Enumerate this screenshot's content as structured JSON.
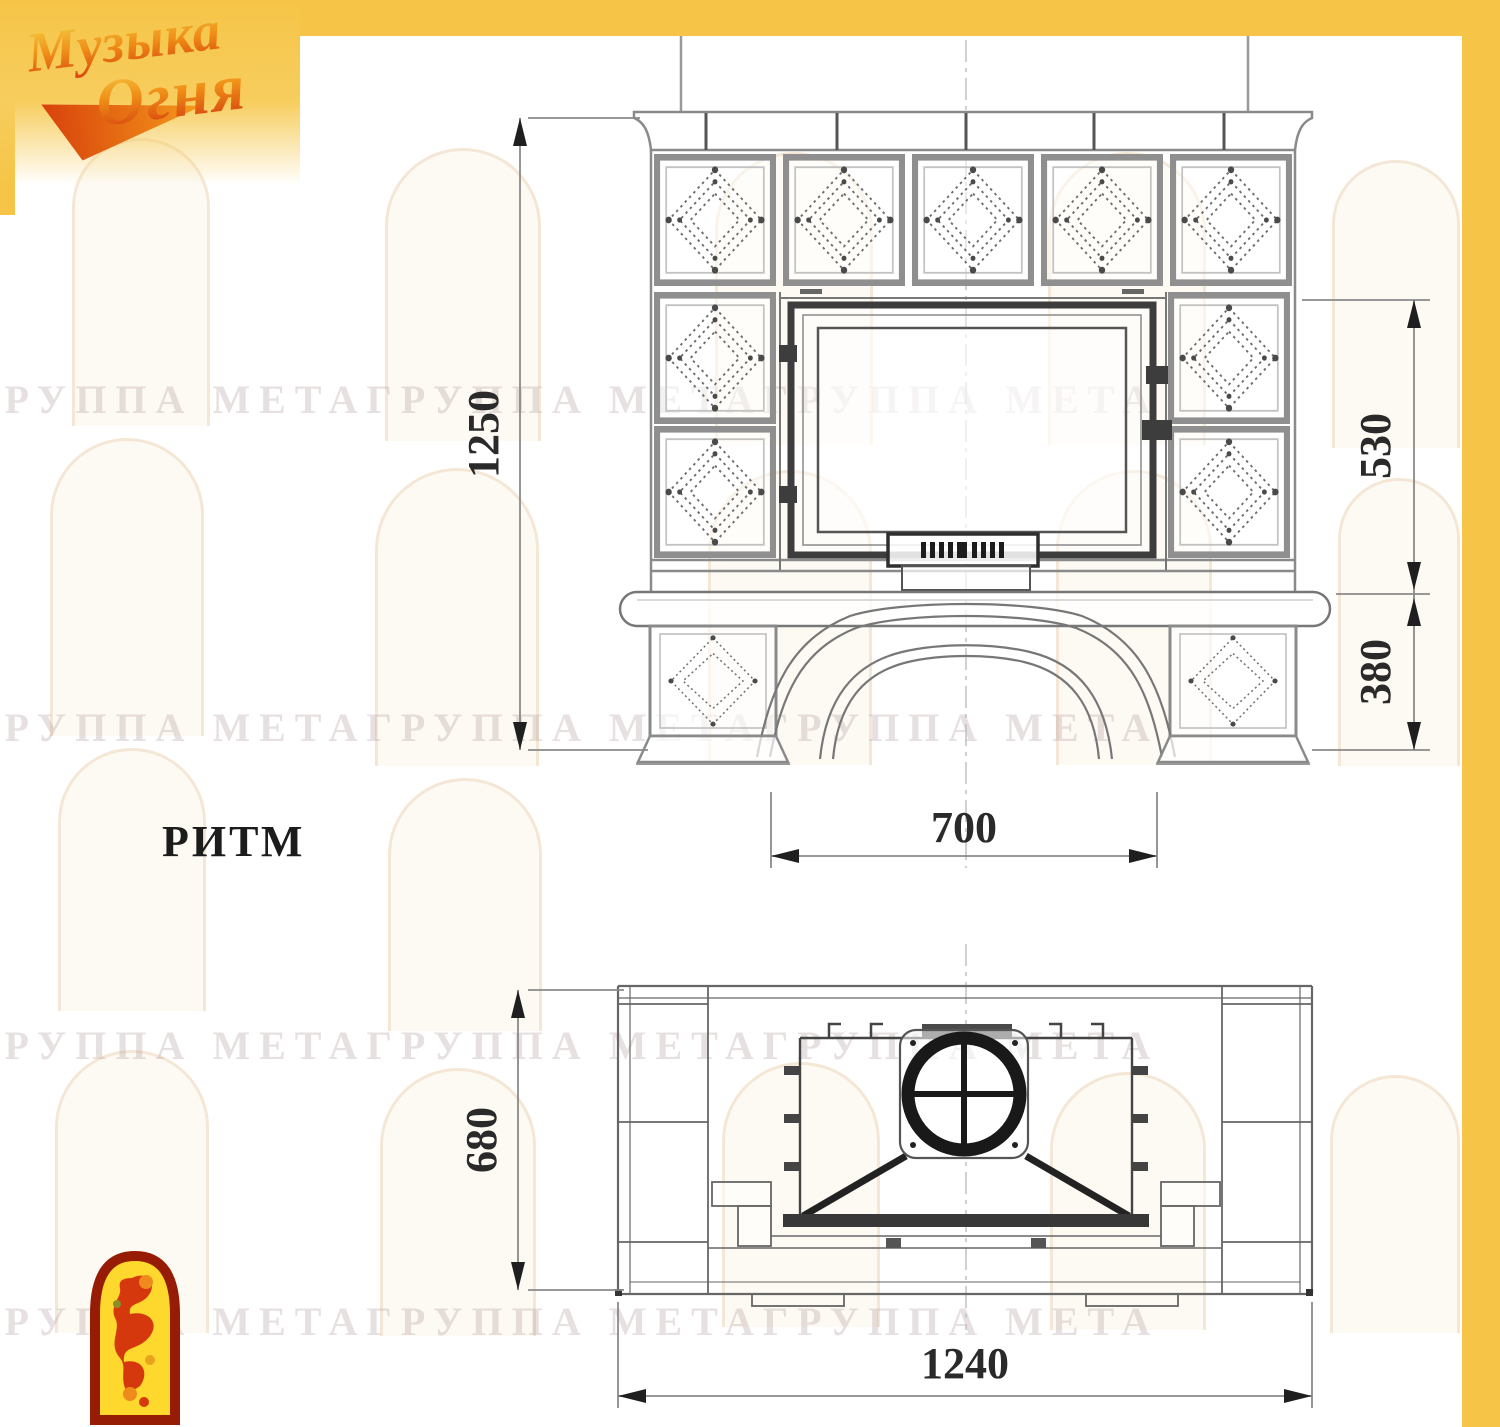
{
  "logo": {
    "word1": "Музыка",
    "word2": "Огня"
  },
  "model_label": "РИТМ",
  "watermark_text": "ГРУППА МЕТАГРУППА МЕТАГРУППА МЕТА",
  "front_view": {
    "dim_total_height": "1250",
    "dim_firebox_zone_height": "530",
    "dim_base_zone_height": "380",
    "dim_opening_width": "700"
  },
  "plan_view": {
    "dim_depth": "680",
    "dim_width": "1240"
  },
  "colors": {
    "accent_yellow": "#f6c547",
    "drawing_line": "#777777",
    "dark_line": "#2b2b2b",
    "dimension_text": "#2a2a2a"
  }
}
